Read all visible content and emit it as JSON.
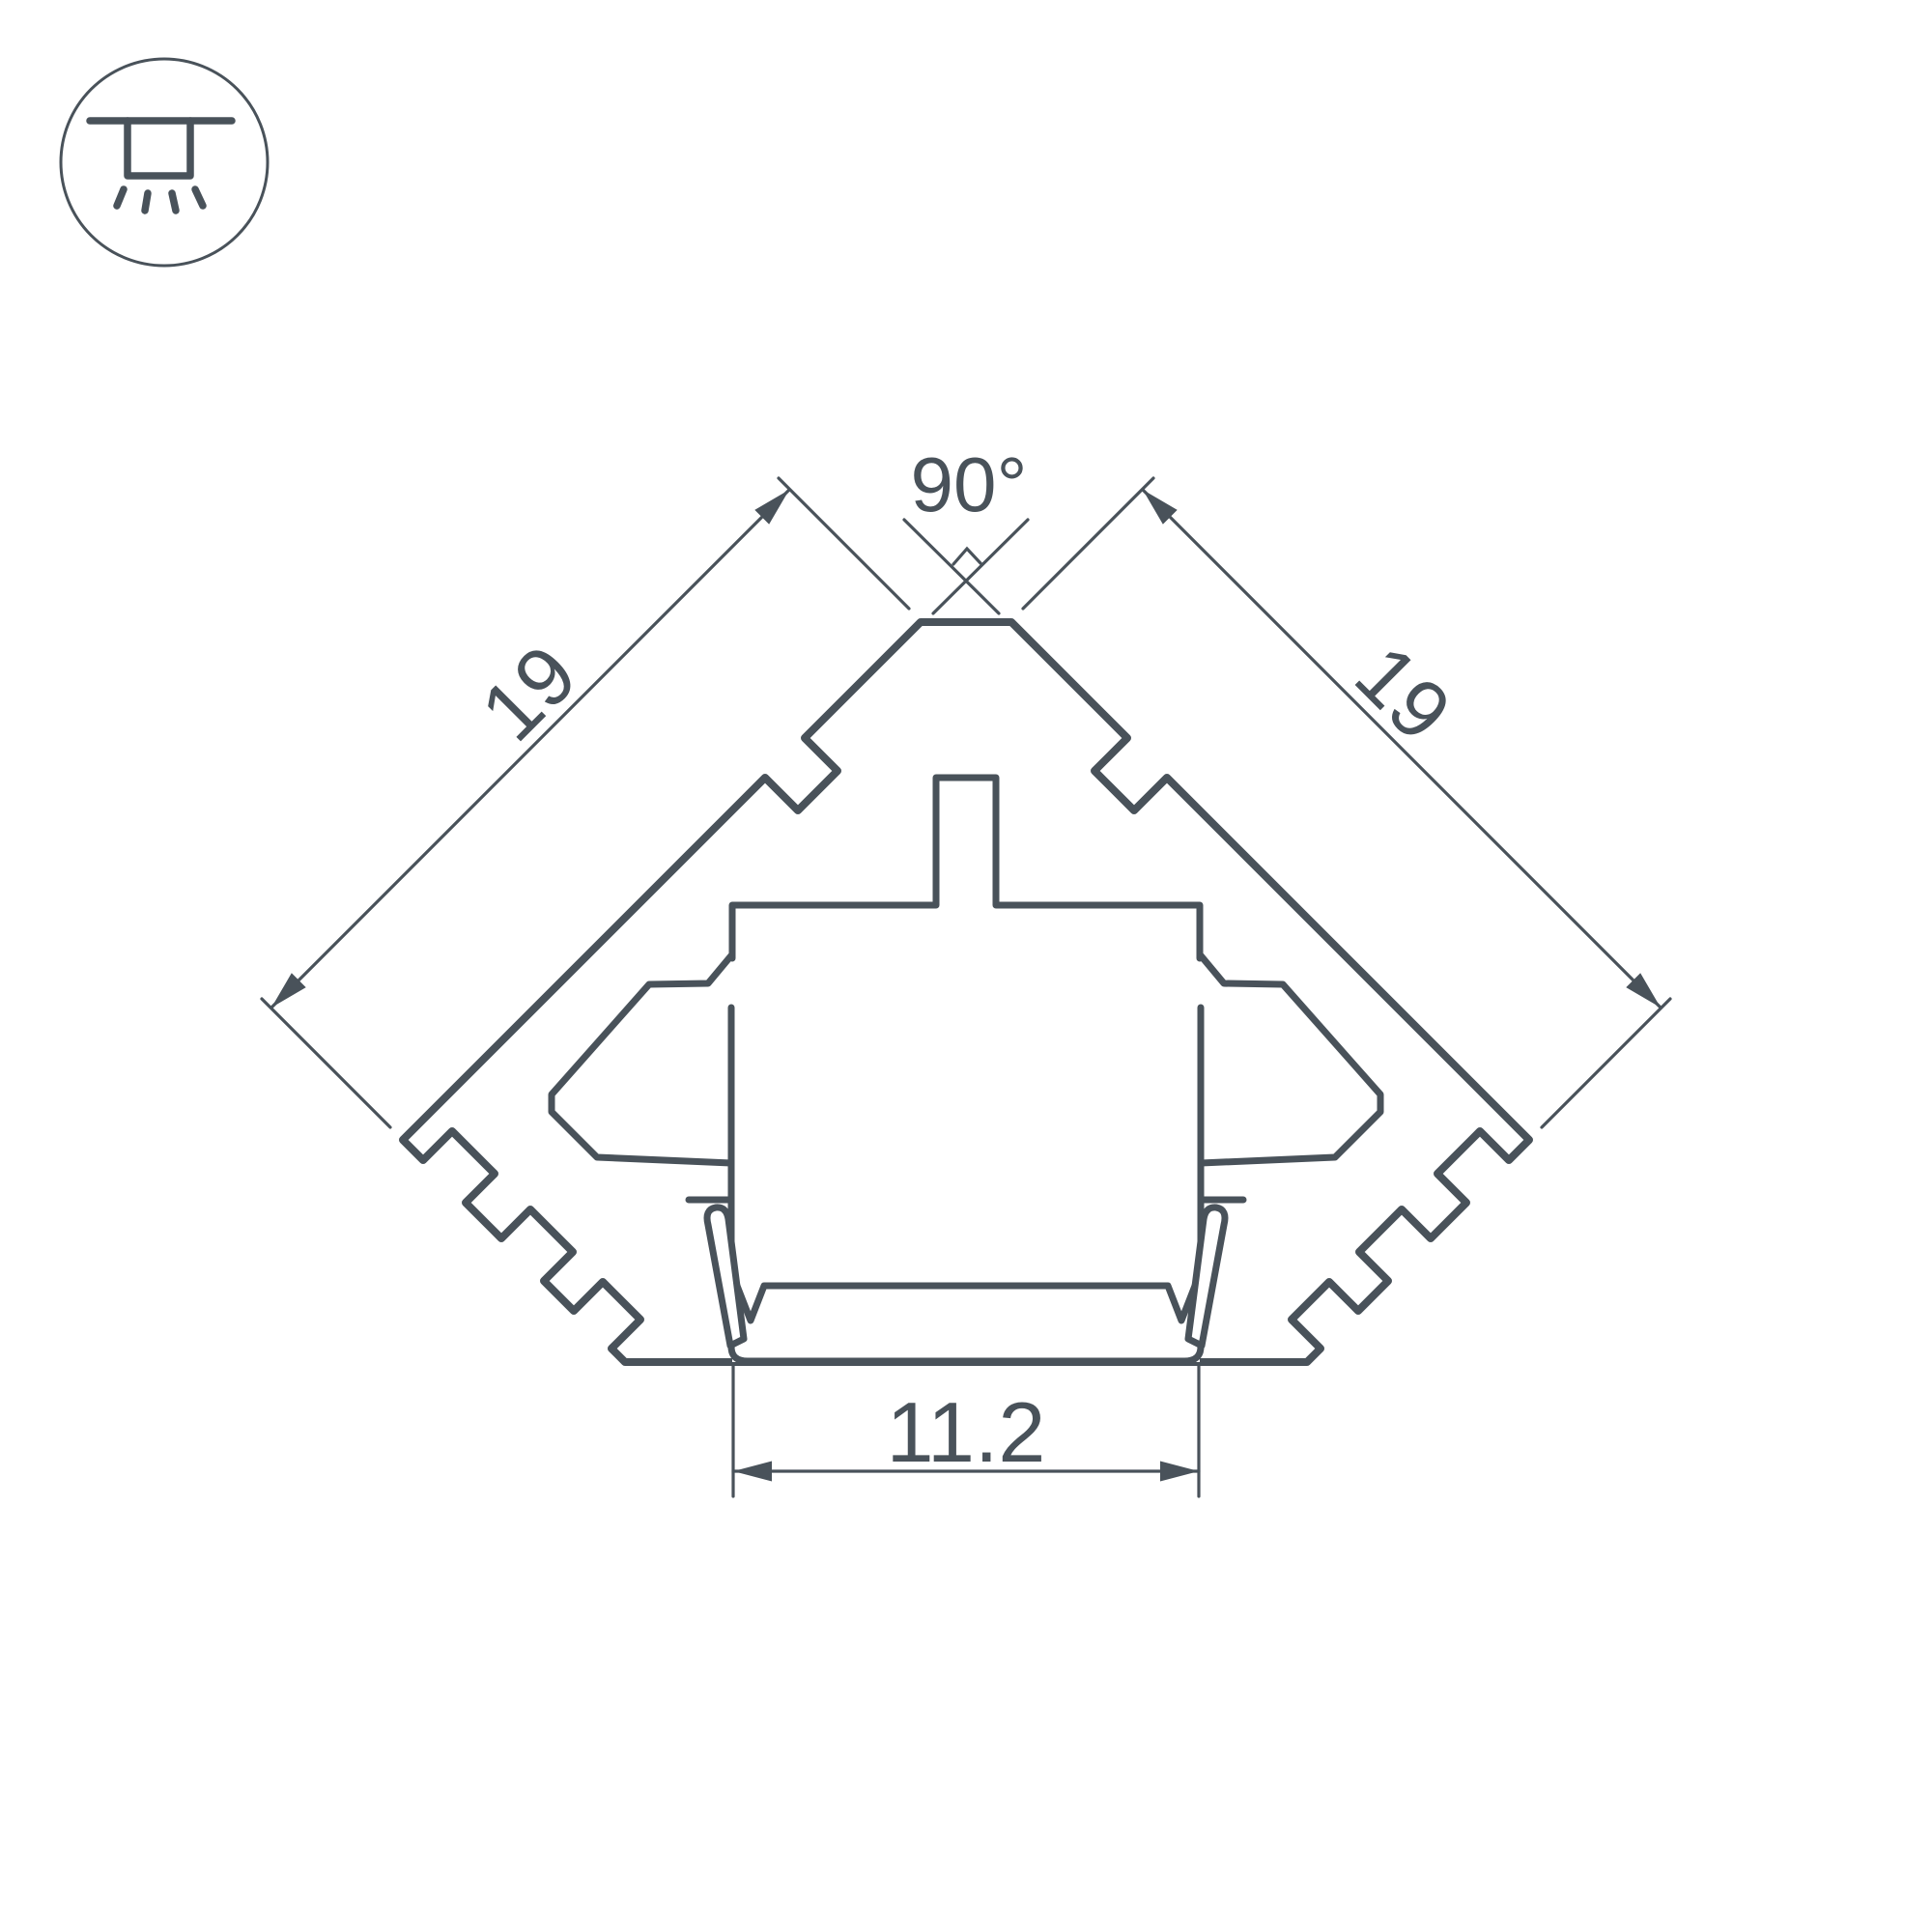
{
  "drawing": {
    "corner_icon": "recessed-ceiling-light-icon",
    "dimensions": {
      "left_side": "19",
      "right_side": "19",
      "apex_angle": "90°",
      "inner_width": "11.2"
    },
    "colors": {
      "line": "#49525a",
      "material_fill": "#edeef0",
      "hatch_line": "#555e64",
      "background": "#ffffff"
    }
  }
}
